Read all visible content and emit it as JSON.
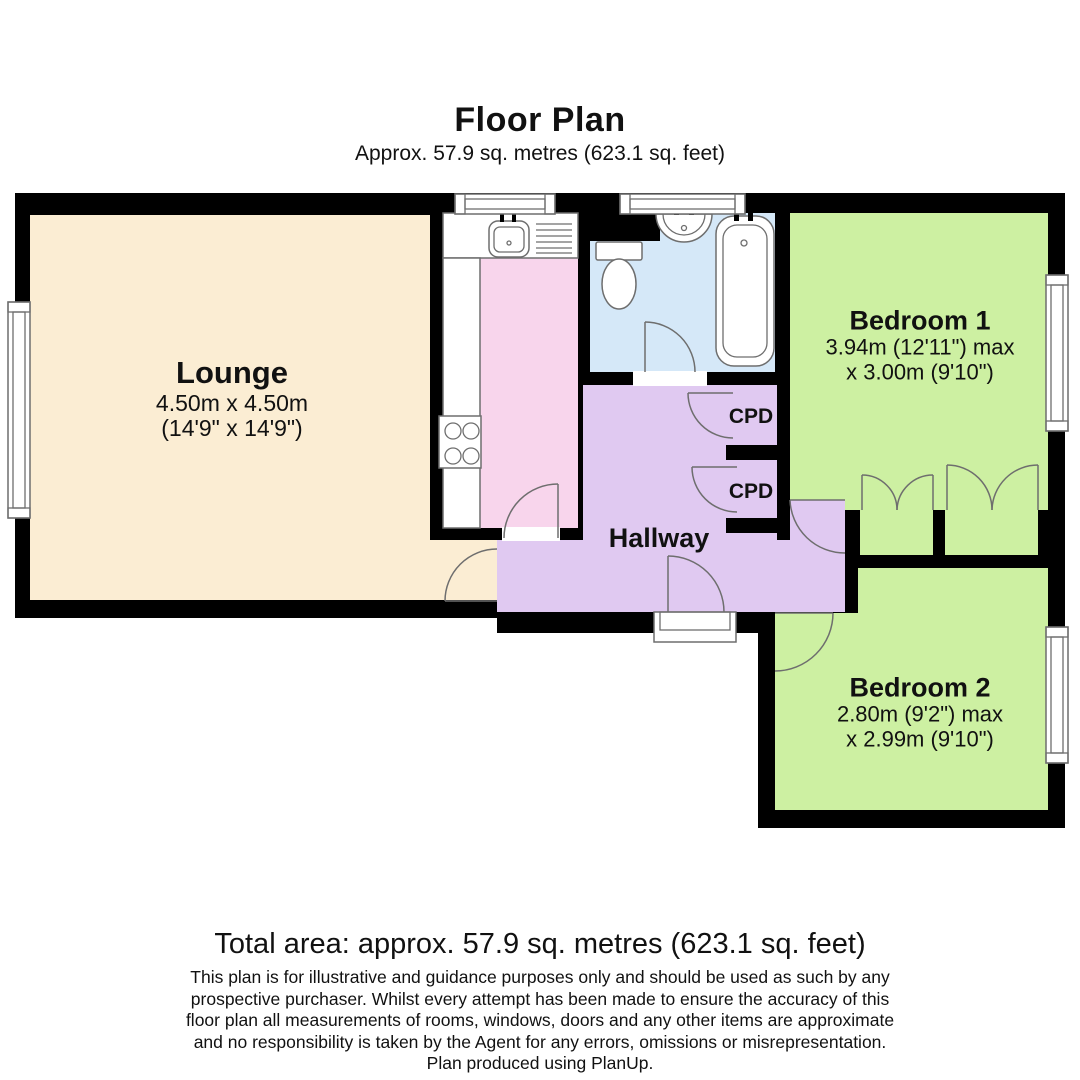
{
  "title": "Floor Plan",
  "subtitle": "Approx. 57.9 sq. metres (623.1 sq. feet)",
  "rooms": {
    "lounge": {
      "name": "Lounge",
      "dims1": "4.50m x 4.50m",
      "dims2": "(14'9\" x 14'9\")"
    },
    "bedroom1": {
      "name": "Bedroom 1",
      "dims1": "3.94m (12'11\") max",
      "dims2": "x 3.00m (9'10\")"
    },
    "bedroom2": {
      "name": "Bedroom 2",
      "dims1": "2.80m (9'2\") max",
      "dims2": "x 2.99m (9'10\")"
    },
    "hallway": {
      "name": "Hallway"
    },
    "cupboard1": {
      "name": "CPD"
    },
    "cupboard2": {
      "name": "CPD"
    }
  },
  "footer": {
    "total_area": "Total area: approx. 57.9 sq. metres (623.1 sq. feet)",
    "disclaimer_lines": [
      "This plan is for illustrative and guidance purposes only and should be used as such by any",
      "prospective purchaser. Whilst every attempt has been made to ensure the accuracy of this",
      "floor plan all measurements of rooms, windows, doors and any other items are approximate",
      "and no responsibility is taken by the Agent for any errors, omissions or misrepresentation.",
      "Plan produced using PlanUp."
    ]
  },
  "colors": {
    "wall": "#000000",
    "lounge": "#FBEDD3",
    "kitchen": "#F8D5EC",
    "bathroom": "#D5E8F8",
    "hallway": "#E0C9F1",
    "bedroom": "#CDF0A2",
    "fixture": "#FFFFFF"
  }
}
